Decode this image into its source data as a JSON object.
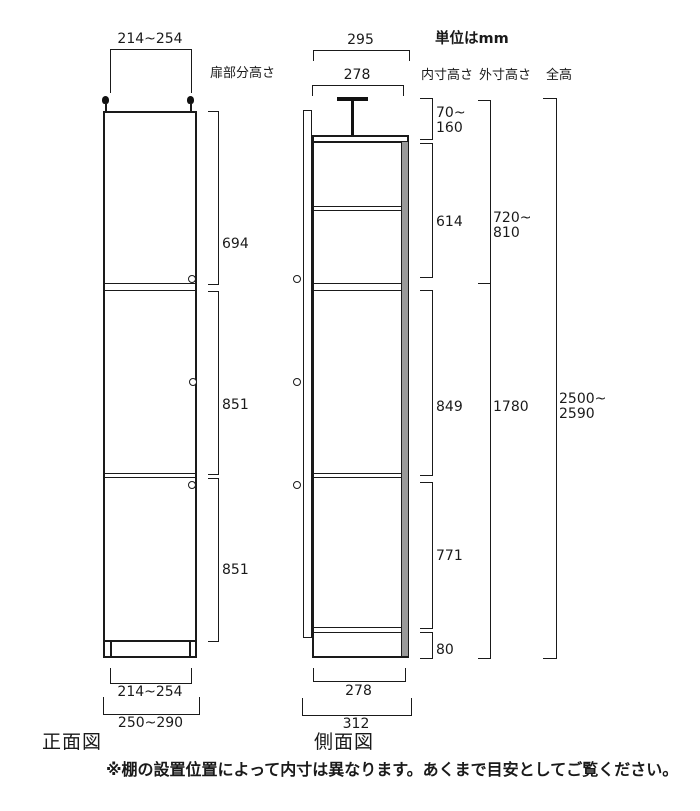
{
  "unit_label": "単位はmm",
  "footnote": "※棚の設置位置によって内寸は異なります。あくまで目安としてご覧ください。",
  "front_view": {
    "title": "正面図",
    "door_section_label": "扉部分高さ",
    "top_width": "214~254",
    "bottom_inner_width": "214~254",
    "bottom_outer_width": "250~290",
    "door_heights": [
      "694",
      "851",
      "851"
    ]
  },
  "side_view": {
    "title": "側面図",
    "top_outer_depth": "295",
    "top_inner_depth": "278",
    "bottom_inner_depth": "278",
    "bottom_outer_depth": "312"
  },
  "inner_height_col": {
    "header": "内寸高さ",
    "seg1_line1": "70~",
    "seg1_line2": "160",
    "seg2": "614",
    "seg3": "849",
    "seg4": "771",
    "seg5": "80"
  },
  "outer_height_col": {
    "header": "外寸高さ",
    "seg1_line1": "720~",
    "seg1_line2": "810",
    "seg2": "1780"
  },
  "total_height_col": {
    "header": "全高",
    "seg1_line1": "2500~",
    "seg1_line2": "2590"
  },
  "colors": {
    "line": "#1a1a1a",
    "back_panel_gray": "#9a9a9a"
  }
}
